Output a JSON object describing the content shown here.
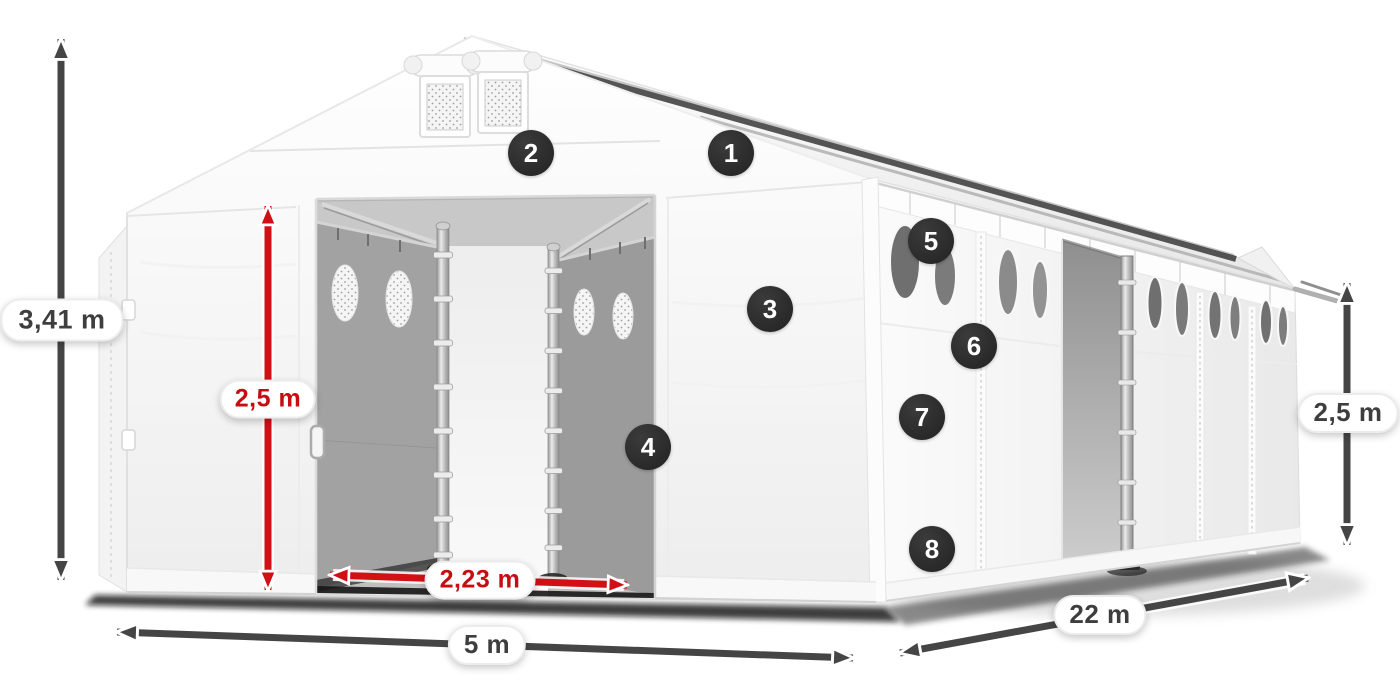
{
  "diagram": {
    "subject": "White PVC storage tent with gabled roof, open front doors and open side entrance, drawn in perspective with dimension arrows and numbered feature callouts",
    "colors": {
      "background": "#ffffff",
      "arrow_dark": "#454545",
      "arrow_red": "#d11016",
      "badge_background": "#2b2b2b",
      "badge_number": "#ffffff",
      "dimension_text_dark": "#3e3e3e",
      "dimension_text_red": "#c50d12",
      "tent_white": "#ffffff",
      "interior_gray": "#a0a0a0"
    },
    "dimensions": {
      "total_height": "3,41 m",
      "door_clear_height": "2,5 m",
      "door_clear_width": "2,23 m",
      "front_width": "5 m",
      "side_length": "22 m",
      "wall_height": "2,5 m"
    },
    "callouts": [
      {
        "number": "1"
      },
      {
        "number": "2"
      },
      {
        "number": "3"
      },
      {
        "number": "4"
      },
      {
        "number": "5"
      },
      {
        "number": "6"
      },
      {
        "number": "7"
      },
      {
        "number": "8"
      }
    ]
  }
}
